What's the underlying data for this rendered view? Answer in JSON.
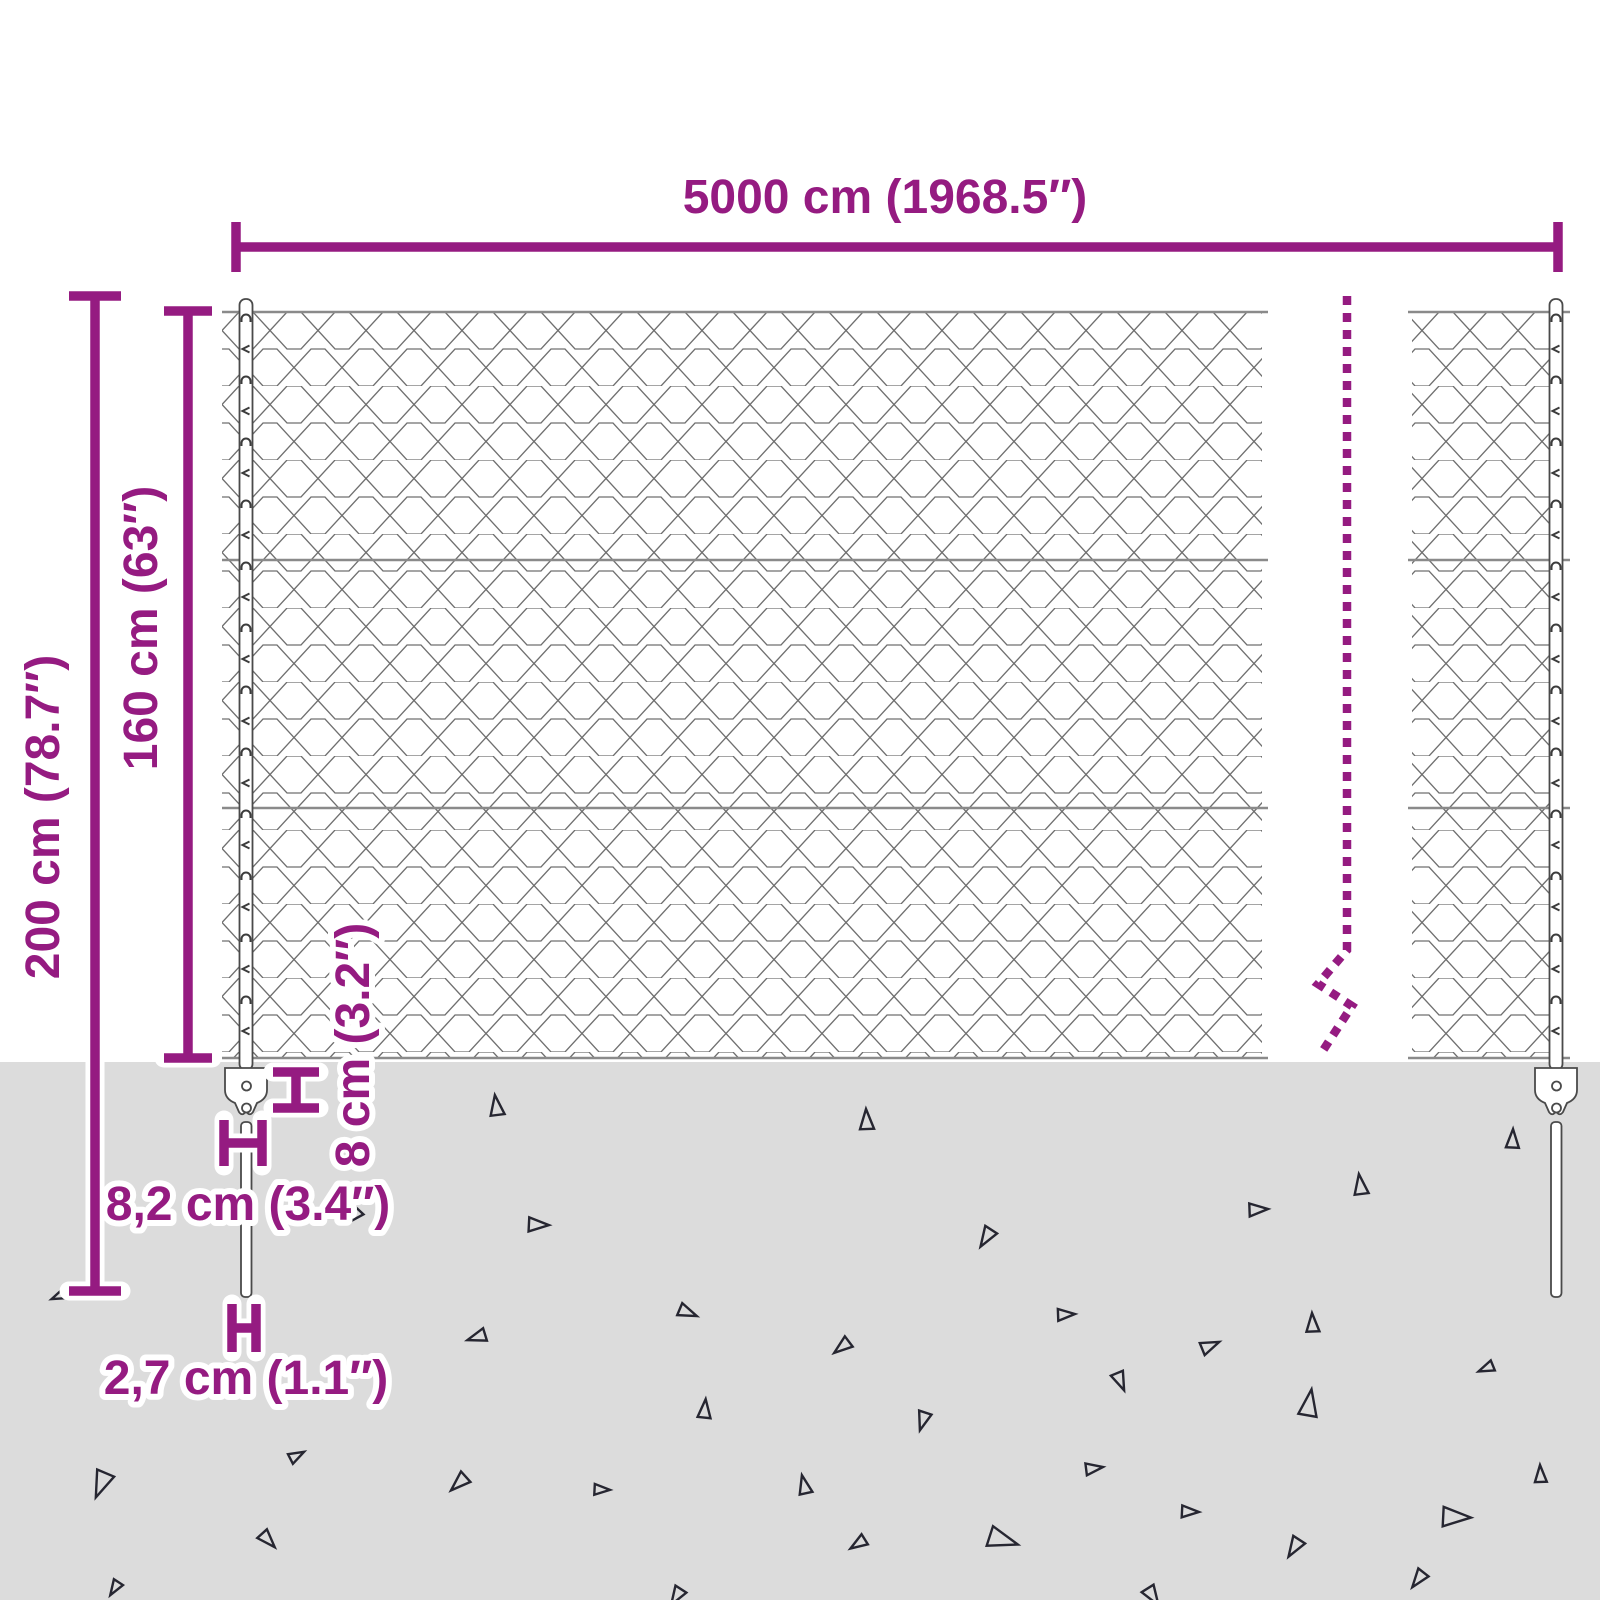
{
  "labels": {
    "width": "5000 cm (1968.5″)",
    "total_height": "200 cm (78.7″)",
    "mesh_height": "160 cm (63″)",
    "plate_height": "8 cm (3.2″)",
    "plate_width": "8,2 cm (3.4″)",
    "post_diameter": "2,7 cm (1.1″)"
  },
  "colors": {
    "accent": "#951b81",
    "halo": "#ffffff",
    "ground": "#dcdcdc",
    "wire": "#8a8a8a",
    "mesh": "#6f6f6f",
    "post_outline": "#4a4a4a",
    "triangle": "#262631"
  },
  "ground": {
    "triangles": [
      [
        496,
        1108,
        13,
        355
      ],
      [
        536,
        1224,
        13,
        95
      ],
      [
        357,
        1215,
        9,
        225
      ],
      [
        60,
        1296,
        9,
        250
      ],
      [
        479,
        1337,
        12,
        255
      ],
      [
        686,
        1311,
        12,
        115
      ],
      [
        704,
        1411,
        12,
        8
      ],
      [
        103,
        1482,
        17,
        205
      ],
      [
        295,
        1456,
        10,
        65
      ],
      [
        461,
        1482,
        13,
        230
      ],
      [
        600,
        1489,
        10,
        95
      ],
      [
        267,
        1538,
        12,
        140
      ],
      [
        116,
        1587,
        10,
        215
      ],
      [
        678,
        1595,
        12,
        215
      ],
      [
        866,
        1122,
        13,
        0
      ],
      [
        1512,
        1141,
        12,
        5
      ],
      [
        1360,
        1187,
        13,
        355
      ],
      [
        1256,
        1209,
        12,
        90
      ],
      [
        988,
        1236,
        13,
        215
      ],
      [
        1064,
        1314,
        11,
        90
      ],
      [
        1312,
        1325,
        12,
        0
      ],
      [
        1208,
        1346,
        12,
        70
      ],
      [
        844,
        1346,
        12,
        235
      ],
      [
        1120,
        1379,
        12,
        160
      ],
      [
        1488,
        1368,
        10,
        250
      ],
      [
        1308,
        1406,
        17,
        12
      ],
      [
        924,
        1419,
        12,
        200
      ],
      [
        1092,
        1468,
        11,
        85
      ],
      [
        804,
        1487,
        12,
        350
      ],
      [
        1188,
        1511,
        11,
        95
      ],
      [
        1000,
        1538,
        19,
        110
      ],
      [
        860,
        1543,
        11,
        240
      ],
      [
        1296,
        1546,
        13,
        215
      ],
      [
        1453,
        1516,
        18,
        95
      ],
      [
        1540,
        1476,
        11,
        0
      ],
      [
        1420,
        1578,
        12,
        220
      ],
      [
        1152,
        1594,
        13,
        150
      ]
    ]
  }
}
